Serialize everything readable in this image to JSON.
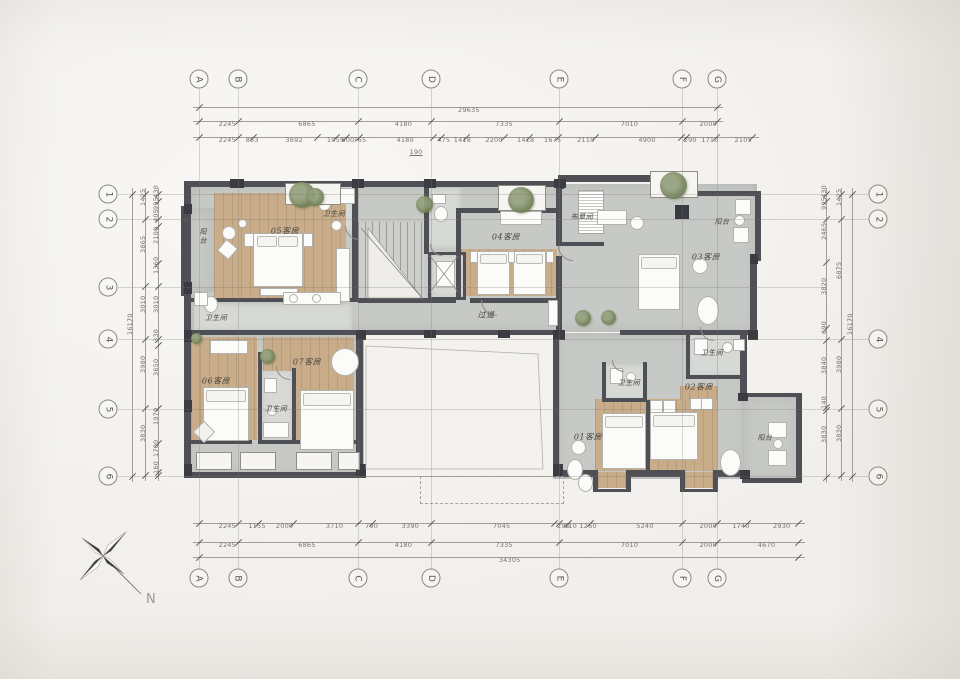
{
  "sheet": {
    "north_label": "N"
  },
  "grid": {
    "cols": [
      "A",
      "B",
      "C",
      "D",
      "E",
      "F",
      "G"
    ],
    "rows_left": [
      "1",
      "2",
      "3",
      "4",
      "5",
      "6"
    ],
    "rows_right": [
      "1",
      "2",
      "4",
      "5",
      "6"
    ]
  },
  "dims": {
    "top_total": "29635",
    "top_major": [
      "2245",
      "6865",
      "4180",
      "7335",
      "7010",
      "2000"
    ],
    "top_detail": [
      "2245",
      "853",
      "3692",
      "1055",
      "600",
      "765",
      "4180",
      "475",
      "1418",
      "2200",
      "1418",
      "1675",
      "2110",
      "4900",
      "290",
      "1710",
      "2105"
    ],
    "top_sub": "190",
    "bottom_detail": [
      "2245",
      "1155",
      "2000",
      "3710",
      "790",
      "3390",
      "7045",
      "290",
      "510",
      "1260",
      "5240",
      "2000",
      "1740",
      "2930"
    ],
    "bottom_major": [
      "2245",
      "6865",
      "4180",
      "7335",
      "7010",
      "2000",
      "4670"
    ],
    "bottom_total": "34305",
    "left_detail": [
      "430",
      "995",
      "405",
      "2100",
      "1360",
      "3010",
      "330",
      "3650",
      "1970",
      "1700",
      "160"
    ],
    "left_major": [
      "1425",
      "3865",
      "3010",
      "3980",
      "3830"
    ],
    "left_total": "16170",
    "right_detail": [
      "430",
      "995",
      "2465",
      "3820",
      "690",
      "3840",
      "140",
      "3830"
    ],
    "right_major": [
      "1425",
      "6875",
      "3980",
      "3830"
    ],
    "right_total": "16170"
  },
  "rooms": {
    "r05": "05客房",
    "r04": "04客房",
    "r03": "03客房",
    "r02": "02客房",
    "r01": "01客房",
    "r06": "06客房",
    "r07": "07客房",
    "bath_top": "卫生间",
    "bath_mid": "卫生间",
    "bath_03": "卫生间",
    "bath_01": "卫生间",
    "bath_67": "卫生间",
    "balcony_left": "阳台",
    "balcony_tr": "阳台",
    "balcony_right": "阳台",
    "linen": "布草间",
    "corridor": "过道"
  },
  "colors": {
    "wall": "#4f5055",
    "concrete": "#c7c9c6",
    "wood": "#c9ad8a",
    "tile": "#d7d9d7",
    "plant": "#76855c",
    "paper": "#f1efeb"
  }
}
